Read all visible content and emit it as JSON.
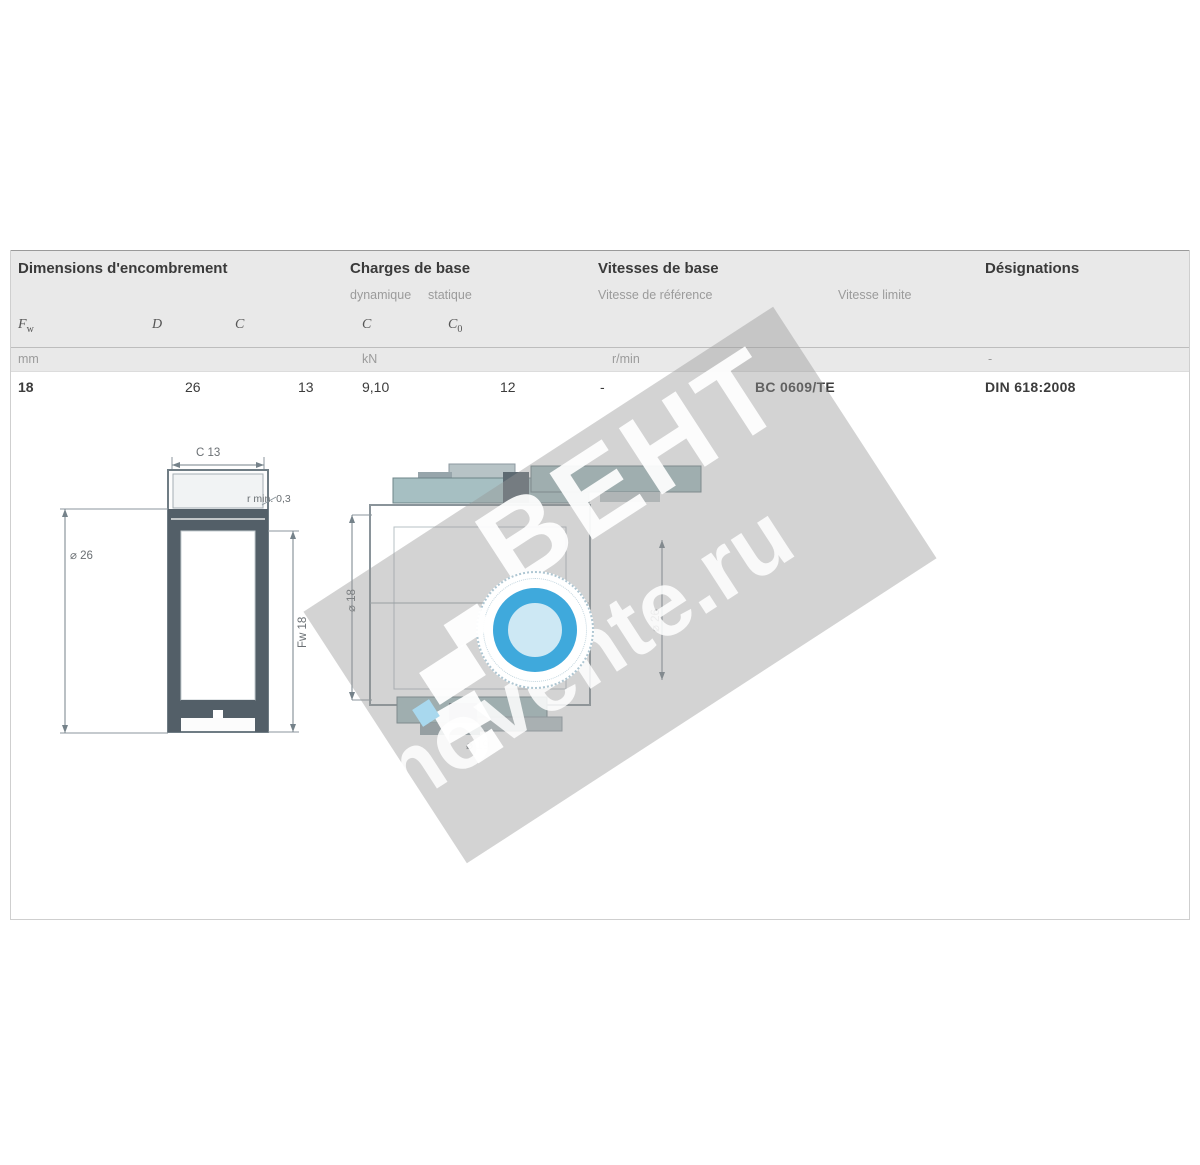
{
  "table": {
    "group_headers": {
      "dimensions": "Dimensions d'encombrement",
      "loads": "Charges de base",
      "speeds": "Vitesses de base",
      "designation": "Désignations"
    },
    "sub_headers": {
      "load_dynamic": "dynamique",
      "load_static": "statique",
      "speed_reference": "Vitesse de référence",
      "speed_limit": "Vitesse limite"
    },
    "symbols": {
      "fw_main": "F",
      "fw_sub": "w",
      "d": "D",
      "c": "C",
      "c_dyn": "C",
      "c0_main": "C",
      "c0_sub": "0"
    },
    "units": {
      "dimensions": "mm",
      "loads": "kN",
      "speeds": "r/min",
      "designation": "-"
    },
    "row": {
      "fw": "18",
      "d": "26",
      "c": "13",
      "c_dyn": "9,10",
      "c0": "12",
      "speed_reference": "-",
      "designation": "BC 0609/TE",
      "standard": "DIN 618:2008"
    }
  },
  "drawing": {
    "left": {
      "width_dim": "C 13",
      "outer_dim": "⌀ 26",
      "bore_dim": "Fw 18",
      "fillet_note": "r min. 0,3"
    },
    "right": {
      "shaft_dim": "⌀ 18",
      "housing_dim": "⌀ 26",
      "bottom_dim": "⌀ 19"
    }
  },
  "watermark": {
    "brand": "ВЕНТ",
    "site": "movente.ru",
    "accent_color": "#3fa9dc"
  }
}
